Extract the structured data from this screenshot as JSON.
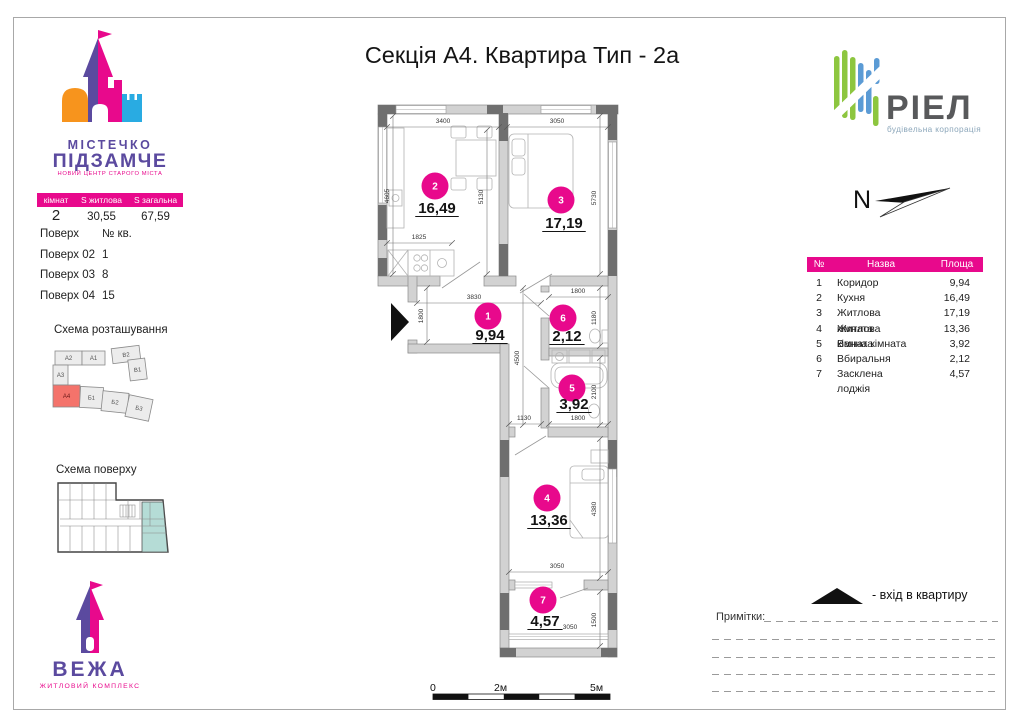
{
  "page": {
    "title": "Секція А4. Квартира Тип - 2а"
  },
  "logo_mistechko": {
    "line1": "МІСТЕЧКО",
    "line2": "ПІДЗАМЧЕ",
    "tagline": "НОВИЙ ЦЕНТР СТАРОГО МІСТА"
  },
  "info_table": {
    "headers": [
      "кімнат",
      "S житлова",
      "S загальна"
    ],
    "values": [
      "2",
      "30,55",
      "67,59"
    ]
  },
  "floors_list": {
    "col_floor": "Поверх",
    "col_apt": "№ кв.",
    "rows": [
      [
        "Поверх 02",
        "1"
      ],
      [
        "Поверх 03",
        "8"
      ],
      [
        "Поверх 04",
        "15"
      ]
    ]
  },
  "site_scheme": {
    "title": "Схема розташування",
    "labels": [
      "А2",
      "А1",
      "В2",
      "В1",
      "А3",
      "А4",
      "Б1",
      "Б2",
      "Б3"
    ],
    "highlighted": "А4"
  },
  "floor_scheme": {
    "title": "Схема поверху"
  },
  "logo_vezha": {
    "name": "ВЕЖА",
    "tagline": "ЖИТЛОВИЙ КОМПЛЕКС"
  },
  "logo_riel": {
    "name": "РІЕЛ",
    "tagline": "будівельна корпорація"
  },
  "compass": {
    "label": "N"
  },
  "rooms_table": {
    "headers": [
      "№",
      "Назва",
      "Площа"
    ],
    "rows": [
      [
        "1",
        "Коридор",
        "9,94"
      ],
      [
        "2",
        "Кухня",
        "16,49"
      ],
      [
        "3",
        "Житлова кімната",
        "17,19"
      ],
      [
        "4",
        "Житлова кімната",
        "13,36"
      ],
      [
        "5",
        "Ванна кімната",
        "3,92"
      ],
      [
        "6",
        "Вбиральня",
        "2,12"
      ],
      [
        "7",
        "Засклена лоджія",
        "4,57"
      ]
    ]
  },
  "legend": {
    "entrance": "- вхід в квартиру"
  },
  "notes": {
    "label": "Примітки:"
  },
  "scale_bar": {
    "labels": [
      "0",
      "2м",
      "5м"
    ]
  },
  "plan": {
    "rooms": [
      {
        "num": "1",
        "area": "9,94"
      },
      {
        "num": "2",
        "area": "16,49"
      },
      {
        "num": "3",
        "area": "17,19"
      },
      {
        "num": "4",
        "area": "13,36"
      },
      {
        "num": "5",
        "area": "3,92"
      },
      {
        "num": "6",
        "area": "2,12"
      },
      {
        "num": "7",
        "area": "4,57"
      }
    ],
    "dims": [
      "3400",
      "3050",
      "4605",
      "5130",
      "5730",
      "1825",
      "3830",
      "1800",
      "1800",
      "1180",
      "4500",
      "2100",
      "1130",
      "1800",
      "4380",
      "3050",
      "1500",
      "3050"
    ]
  },
  "colors": {
    "brand_magenta": "#e8098c",
    "brand_purple": "#5b4a9f",
    "brand_orange": "#f7941d",
    "brand_blue": "#29abe2",
    "riel_green": "#8dc63f",
    "riel_blue": "#5b9bd5",
    "riel_gray": "#58595b",
    "site_highlight": "#f4736b",
    "floor_highlight": "#b5dcd6"
  }
}
